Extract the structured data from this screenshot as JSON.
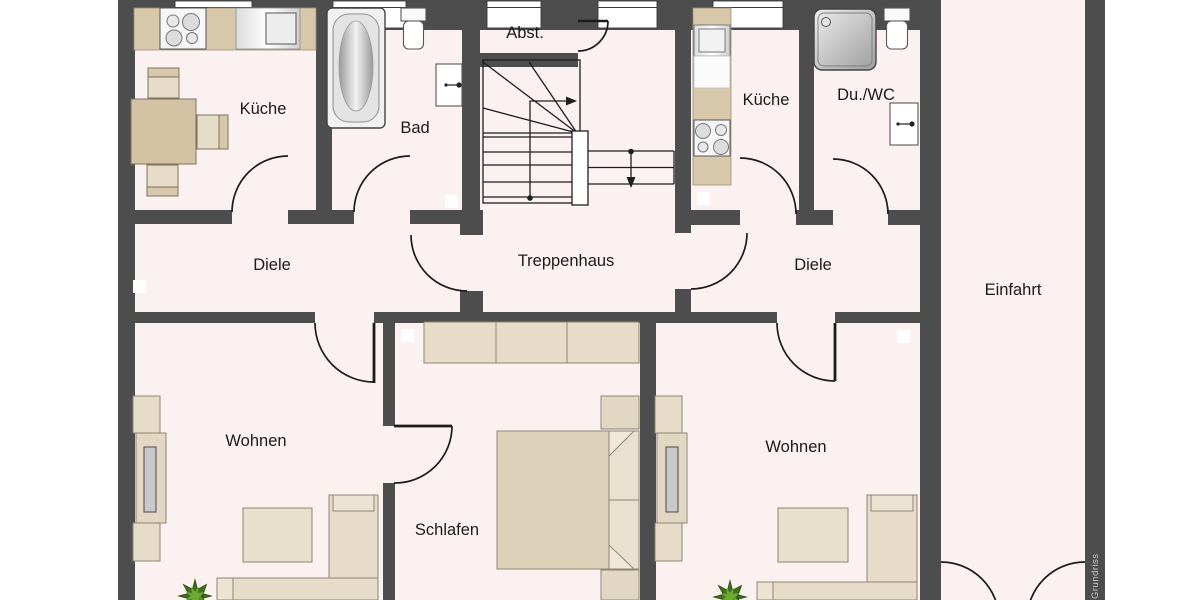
{
  "title": "Erdgeschoss Grundriss",
  "watermark": "Grundriss",
  "rooms": [
    {
      "id": "kueche-left",
      "label": "Küche"
    },
    {
      "id": "bad",
      "label": "Bad"
    },
    {
      "id": "abstellraum",
      "label": "Abst."
    },
    {
      "id": "kueche-right",
      "label": "Küche"
    },
    {
      "id": "du-wc",
      "label": "Du./WC"
    },
    {
      "id": "diele-left",
      "label": "Diele"
    },
    {
      "id": "treppenhaus",
      "label": "Treppenhaus"
    },
    {
      "id": "diele-right",
      "label": "Diele"
    },
    {
      "id": "einfahrt",
      "label": "Einfahrt"
    },
    {
      "id": "wohnen-left",
      "label": "Wohnen"
    },
    {
      "id": "schlafen",
      "label": "Schlafen"
    },
    {
      "id": "wohnen-right",
      "label": "Wohnen"
    }
  ],
  "fixtures": [
    "stove-top",
    "kitchen-sink",
    "refrigerator",
    "dining-table",
    "chair",
    "bathtub",
    "toilet",
    "washbasin",
    "shower",
    "staircase",
    "direction-arrow",
    "sofa",
    "double-bed",
    "pillow",
    "nightstand",
    "coffee-table",
    "corner-sofa",
    "tv-sideboard",
    "wall-cabinet",
    "plant",
    "double-entry-door",
    "window",
    "door-swing"
  ],
  "colors": {
    "wall": "#4d4d4d",
    "floor": "#fcf1f1",
    "outside": "#ffffff",
    "furniture": "#e6dcc8",
    "furniture_border": "#8d8575",
    "counter": "#d8c8ab",
    "appliance": "#f4f4f4",
    "tv_gray": "#c7c9cb",
    "line": "#222222",
    "plant_green": "#4e8a1e",
    "watermark_text": "#c9c9c9"
  }
}
